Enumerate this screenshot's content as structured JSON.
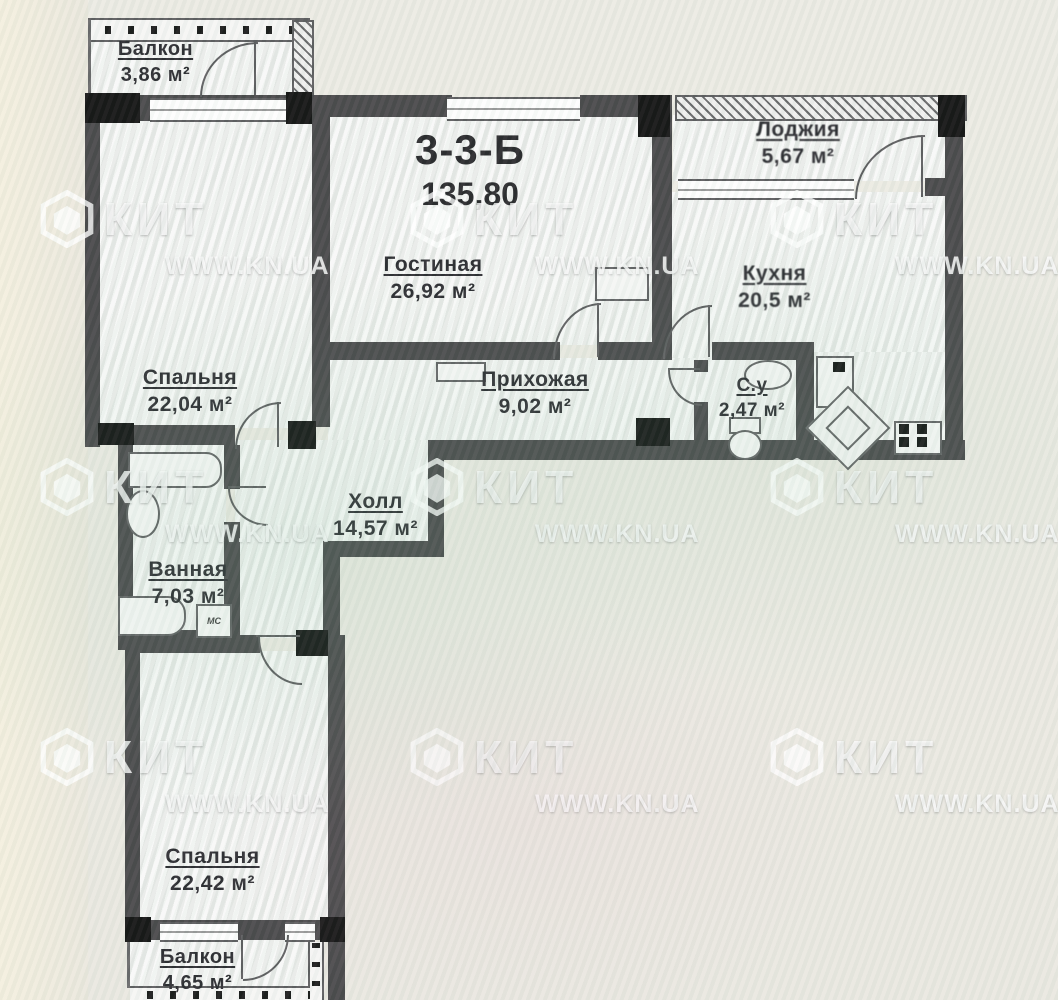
{
  "title": {
    "unit": "3-3-Б",
    "total_area": "135,80"
  },
  "rooms": {
    "balcony_top": {
      "name": "Балкон",
      "area": "3,86 м²"
    },
    "bedroom_top": {
      "name": "Спальня",
      "area": "22,04 м²"
    },
    "living_room": {
      "name": "Гостиная",
      "area": "26,92 м²"
    },
    "loggia": {
      "name": "Лоджия",
      "area": "5,67 м²"
    },
    "kitchen": {
      "name": "Кухня",
      "area": "20,5 м²"
    },
    "entry_hall": {
      "name": "Прихожая",
      "area": "9,02 м²"
    },
    "wc": {
      "name": "С.у",
      "area": "2,47 м²"
    },
    "hall": {
      "name": "Холл",
      "area": "14,57 м²"
    },
    "bathroom": {
      "name": "Ванная",
      "area": "7,03 м²"
    },
    "bedroom_bottom": {
      "name": "Спальня",
      "area": "22,42 м²"
    },
    "balcony_bottom": {
      "name": "Балкон",
      "area": "4,65 м²"
    }
  },
  "appliances": {
    "washing_machine": "МС"
  },
  "watermark": {
    "logo": "КИТ",
    "site": "WWW.KN.UA"
  },
  "colors": {
    "wall": "#4b4a4c",
    "column": "#161616",
    "paper": "#f1f2f0",
    "background": "#eae8e1"
  }
}
